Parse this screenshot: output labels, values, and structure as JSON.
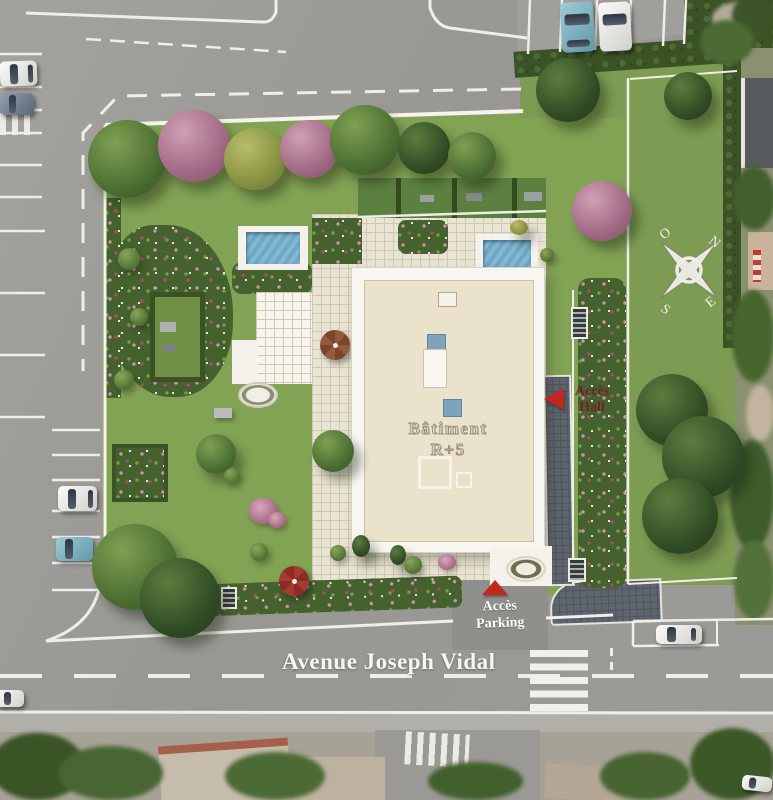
{
  "plan": {
    "building": {
      "label_line1": "Bâtiment",
      "label_line2": "R+5"
    },
    "access_hall": {
      "word1": "Accès",
      "word2": "Hall"
    },
    "access_parking": {
      "word1": "Accès",
      "word2": "Parking"
    },
    "avenue_name": "Avenue Joseph Vidal",
    "compass": {
      "north": "N",
      "south": "S",
      "east": "E",
      "west": "O"
    },
    "colors": {
      "road_gray": "#9c9b97",
      "lawn_green": "#83a355",
      "building_beige": "#ebe2cc",
      "pool_blue": "#6fa7c6",
      "arrow_red": "#c1271b",
      "hall_text_red": "#6f1f28",
      "marking_white": "#f0efe9"
    }
  }
}
